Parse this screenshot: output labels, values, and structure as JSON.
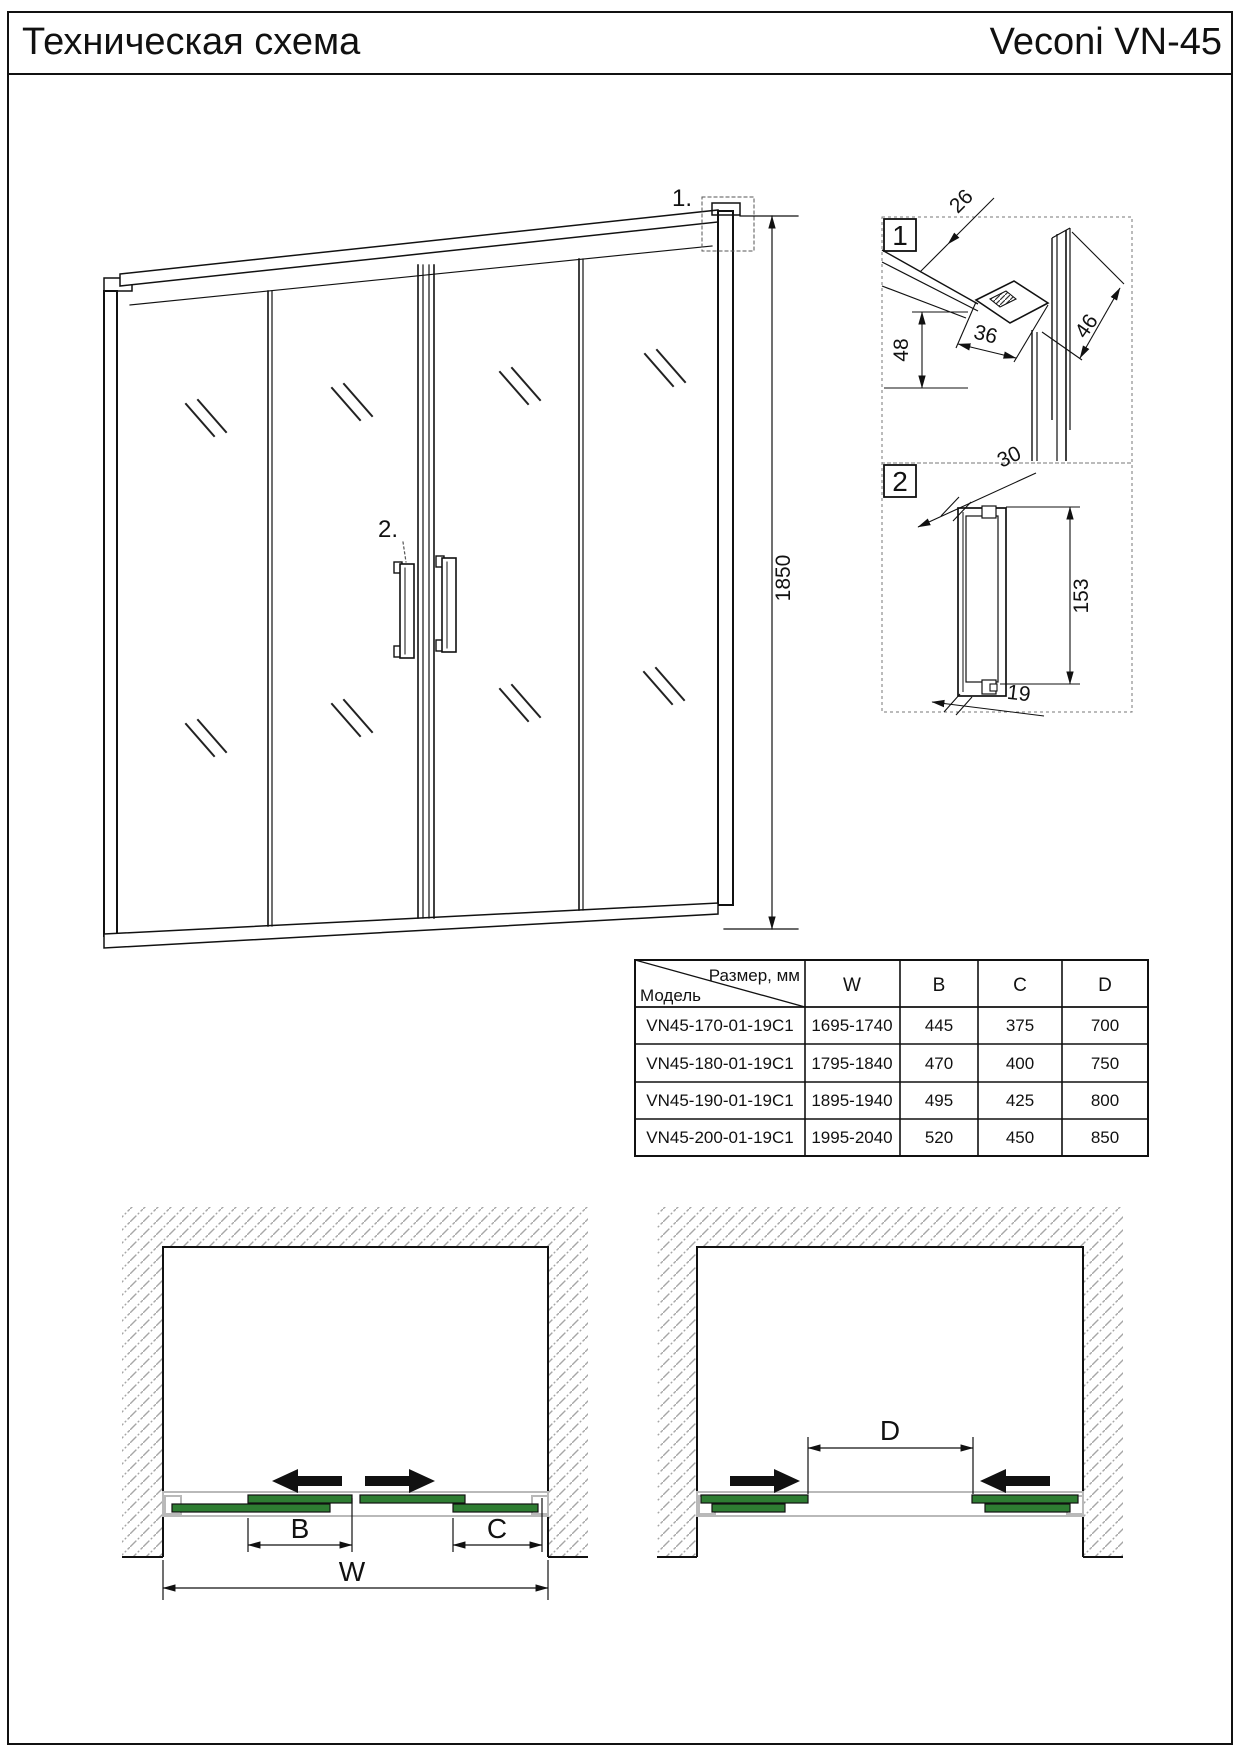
{
  "header": {
    "title_left": "Техническая схема",
    "title_right": "Veconi VN-45"
  },
  "drawing": {
    "callout_1": "1.",
    "callout_2": "2.",
    "height_dim": "1850"
  },
  "detail_1": {
    "label": "1",
    "dim_top": "26",
    "dim_left": "48",
    "dim_mid": "36",
    "dim_right": "46"
  },
  "detail_2": {
    "label": "2",
    "dim_top": "30",
    "dim_right": "153",
    "dim_bottom": "19"
  },
  "table": {
    "size_label": "Размер, мм",
    "model_label": "Модель",
    "col_w": "W",
    "col_b": "B",
    "col_c": "C",
    "col_d": "D",
    "rows": [
      {
        "model": "VN45-170-01-19C1",
        "w": "1695-1740",
        "b": "445",
        "c": "375",
        "d": "700"
      },
      {
        "model": "VN45-180-01-19C1",
        "w": "1795-1840",
        "b": "470",
        "c": "400",
        "d": "750"
      },
      {
        "model": "VN45-190-01-19C1",
        "w": "1895-1940",
        "b": "495",
        "c": "425",
        "d": "800"
      },
      {
        "model": "VN45-200-01-19C1",
        "w": "1995-2040",
        "b": "520",
        "c": "450",
        "d": "850"
      }
    ]
  },
  "plan_left": {
    "dim_b": "B",
    "dim_c": "C",
    "dim_w": "W"
  },
  "plan_right": {
    "dim_d": "D"
  },
  "colors": {
    "door_green": "#2e7d32",
    "track_gray": "#b9b9b9",
    "hatch_gray": "#a6a6a6"
  }
}
